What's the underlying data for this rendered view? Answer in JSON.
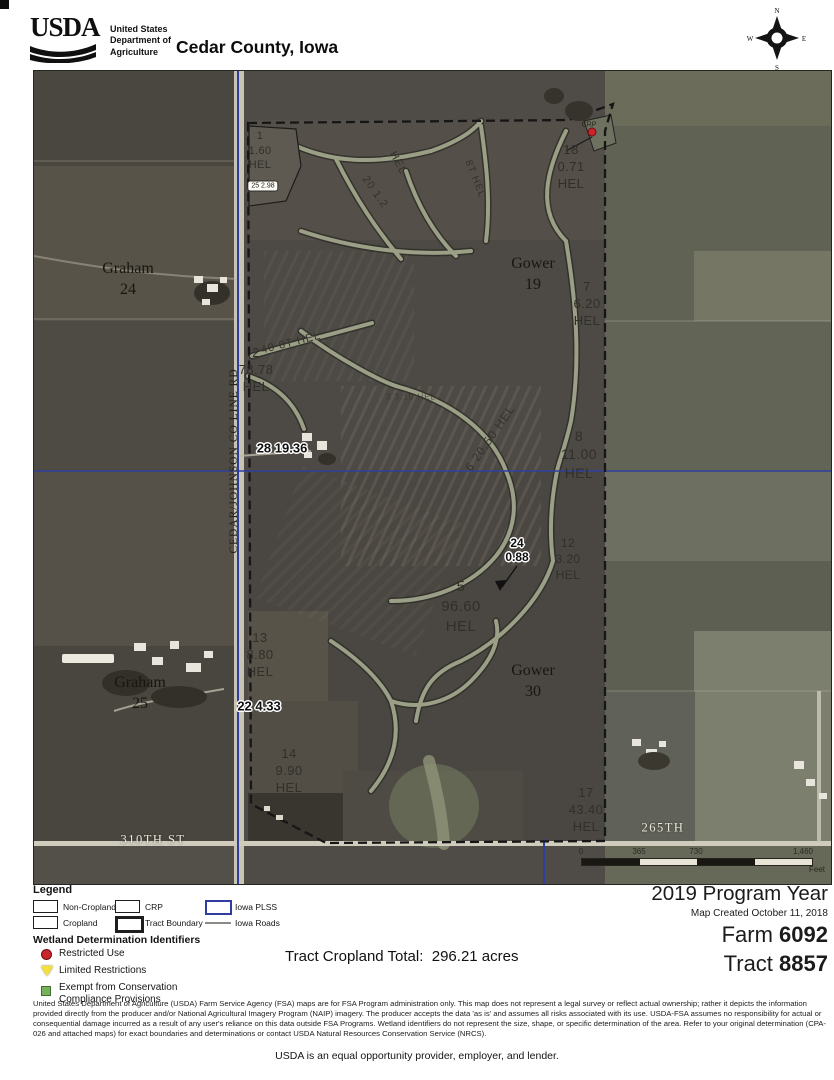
{
  "header": {
    "logo_text": "USDA",
    "dept_line1": "United States",
    "dept_line2": "Department of",
    "dept_line3": "Agriculture",
    "title": "Cedar County, Iowa"
  },
  "compass": {
    "n": "N",
    "e": "E",
    "s": "S",
    "w": "W"
  },
  "map": {
    "road_labels": {
      "co_line_rd": "CEDAR/JOHNSON CO LINE RD",
      "st_310": "310TH ST",
      "th_265": "265TH"
    },
    "place_labels": [
      {
        "name": "Graham",
        "section": "24"
      },
      {
        "name": "Gower",
        "section": "19"
      },
      {
        "name": "Gower",
        "section": "30"
      },
      {
        "name": "Graham",
        "section": "25"
      }
    ],
    "fields": [
      {
        "number": "1",
        "acres": "1.60",
        "hel": "HEL"
      },
      {
        "number": "18",
        "acres": "0.71",
        "hel": "HEL"
      },
      {
        "number": "7",
        "acres": "6.20",
        "hel": "HEL"
      },
      {
        "number": "2",
        "acres": "78.78",
        "hel": "HEL"
      },
      {
        "number": "8",
        "acres": "11.00",
        "hel": "HEL"
      },
      {
        "number": "12",
        "acres": "3.20",
        "hel": "HEL"
      },
      {
        "number": "5",
        "acres": "96.60",
        "hel": "HEL"
      },
      {
        "number": "13",
        "acres": "8.80",
        "hel": "HEL"
      },
      {
        "number": "14",
        "acres": "9.90",
        "hel": "HEL"
      },
      {
        "number": "17",
        "acres": "43.40",
        "hel": "HEL"
      }
    ],
    "outlined_labels": [
      {
        "text": "25 2.98"
      },
      {
        "text": "28 19.36"
      },
      {
        "line1": "24",
        "line2": "0.88"
      },
      {
        "text": "22 4.33"
      }
    ],
    "annotations": [
      {
        "text": "20 1.2"
      },
      {
        "text": "HEL"
      },
      {
        "text": "8T HEL"
      },
      {
        "text": "40 8T HEL"
      },
      {
        "text": "3 3.10 HEL"
      },
      {
        "text": "6 20.50 HEL"
      },
      {
        "text": "CRP"
      }
    ],
    "scale_bar": {
      "tick0": "0",
      "tick1": "365",
      "tick2": "730",
      "tick3": "1,460",
      "unit": "Feet"
    }
  },
  "legend": {
    "title": "Legend",
    "items": [
      {
        "label": "Non-Cropland"
      },
      {
        "label": "CRP"
      },
      {
        "label": "Iowa PLSS"
      },
      {
        "label": "Cropland"
      },
      {
        "label": "Tract Boundary"
      },
      {
        "label": "Iowa Roads"
      }
    ],
    "wetland_title": "Wetland Determination Identifiers",
    "wetland_items": [
      {
        "label": "Restricted Use"
      },
      {
        "label": "Limited Restrictions"
      },
      {
        "label": "Exempt from Conservation Compliance Provisions"
      }
    ],
    "colors": {
      "plss_blue": "#2f3e9e",
      "restricted_red": "#c9252b",
      "limited_yellow": "#f3e13b",
      "exempt_green": "#76b25e"
    }
  },
  "info": {
    "tract_total_label": "Tract Cropland Total:",
    "tract_total_value": "296.21 acres",
    "program_year": "2019 Program Year",
    "map_created": "Map Created October 11, 2018",
    "farm_label": "Farm",
    "farm_value": "6092",
    "tract_label": "Tract",
    "tract_value": "8857"
  },
  "footer": {
    "disclaimer": "United States Department of Agriculture (USDA) Farm Service Agency (FSA) maps are for FSA Program administration only.  This map does not represent a legal survey or reflect actual ownership; rather it depicts the information provided directly from the producer and/or National Agricultural Imagery Program (NAIP) imagery.  The producer accepts the data 'as is' and assumes all risks associated with its use.  USDA-FSA assumes no responsibility for actual or consequential damage incurred as a result of any user's reliance on this data outside FSA Programs.  Wetland identifiers do not represent the size, shape, or specific determination of the area.  Refer to your original determination (CPA-026 and attached maps) for exact boundaries and determinations or contact USDA Natural Resources Conservation Service (NRCS).",
    "equal_opportunity": "USDA is an equal opportunity provider, employer, and lender."
  }
}
